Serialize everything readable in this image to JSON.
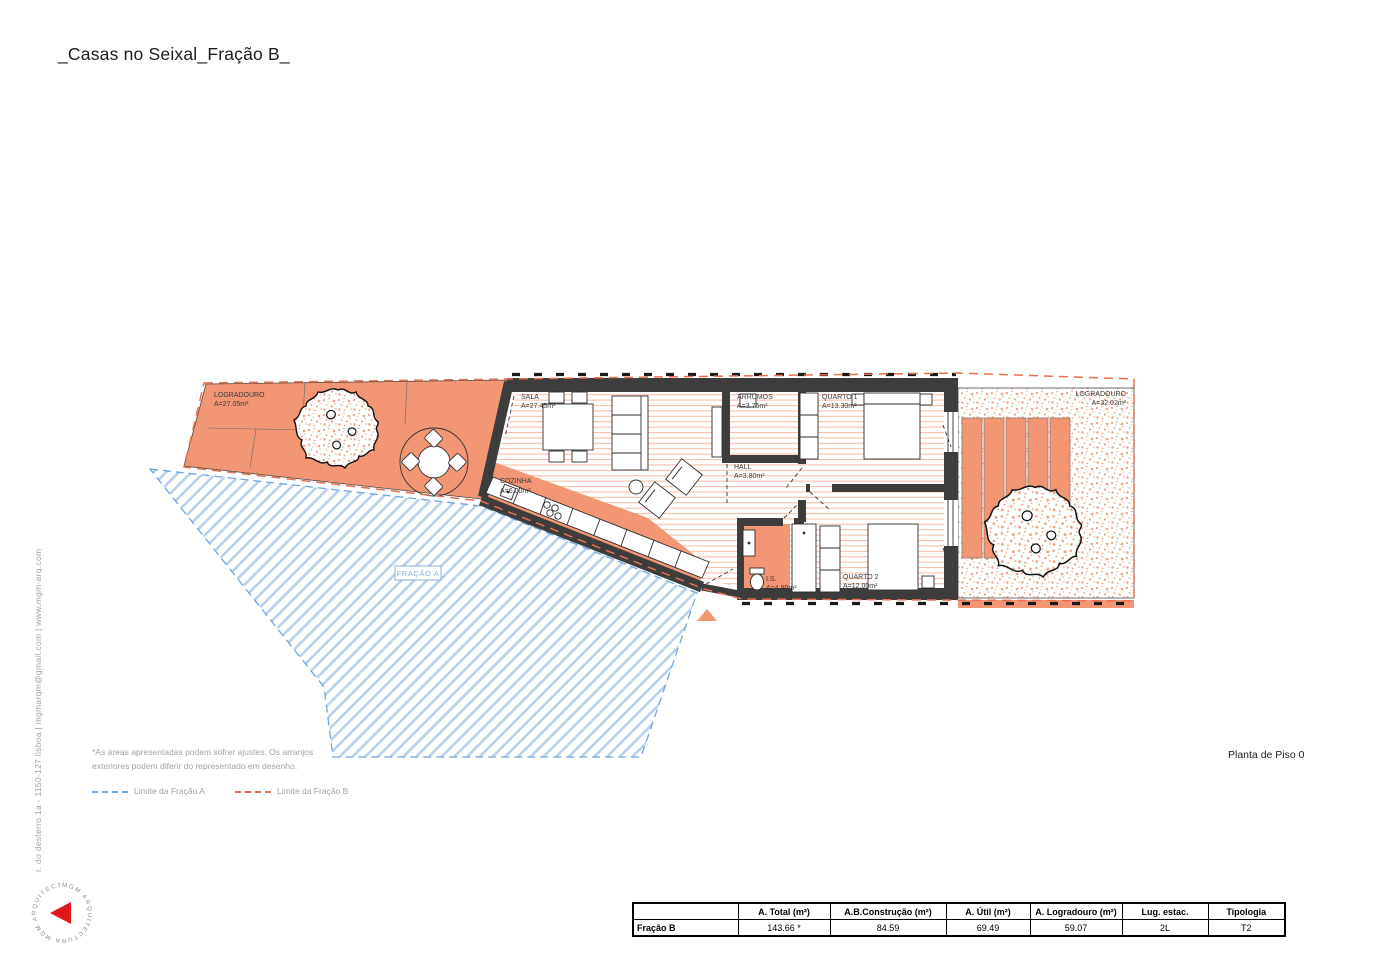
{
  "colors": {
    "salmon": "#f29673",
    "floor-line": "#f7c0a8",
    "stipple-dot": "#f0a183",
    "wall": "#3d3d3d",
    "blue-hatch": "#b7d0ee",
    "blue-dash": "#6fa6dd",
    "orange-dash": "#e76f52",
    "fracao-a-blue": "#8ab0de",
    "gray-text": "#a2a2a2",
    "ink": "#1c1c1c",
    "logo-red": "#e2171e"
  },
  "title": "_Casas no Seixal_Fração B_",
  "studio": {
    "contact_vertical": "r. do desterro 1a - 1150-127 lisboa | mgmarqm@gmail.com | www.mgm-arq.com",
    "logo_circular_text": "MGM ARQUITECTURA   MGM ARQUITECTURA"
  },
  "plan": {
    "caption": "Planta de Piso 0",
    "fracao_a_label": "FRAÇÃO A",
    "rooms": {
      "logradouro_left": {
        "name": "LOGRADOURO",
        "area": "A=27.05m²"
      },
      "sala": {
        "name": "SALA",
        "area": "A=27.45m²"
      },
      "cozinha": {
        "name": "COZINHA",
        "area": "A=6.00m²"
      },
      "arrumos": {
        "name": "ARRUMOS",
        "area": "A=3.75m²"
      },
      "quarto1": {
        "name": "QUARTO 1",
        "area": "A=13.30m²"
      },
      "hall": {
        "name": "HALL",
        "area": "A=3.80m²"
      },
      "is": {
        "name": "I.S.",
        "area": "A=4.90m²"
      },
      "quarto2": {
        "name": "QUARTO 2",
        "area": "A=12.00m²"
      },
      "logradouro_right": {
        "name": "LOGRADOURO",
        "area": "A=32.02m²"
      }
    }
  },
  "notes": {
    "line1": "*As áreas apresentadas podem sofrer ajustes. Os arranjos",
    "line2": "exteriores podem diferir do representado em desenho."
  },
  "legend": {
    "fracao_a": "Limite da Fração A",
    "fracao_b": "Limite da Fração B"
  },
  "table": {
    "headers": [
      "",
      "A. Total (m²)",
      "A.B.Construção (m²)",
      "A. Útil (m²)",
      "A. Logradouro (m²)",
      "Lug. estac.",
      "Tipologia"
    ],
    "row_label": "Fração B",
    "row_values": [
      "143.66 *",
      "84.59",
      "69.49",
      "59.07",
      "2L",
      "T2"
    ]
  }
}
